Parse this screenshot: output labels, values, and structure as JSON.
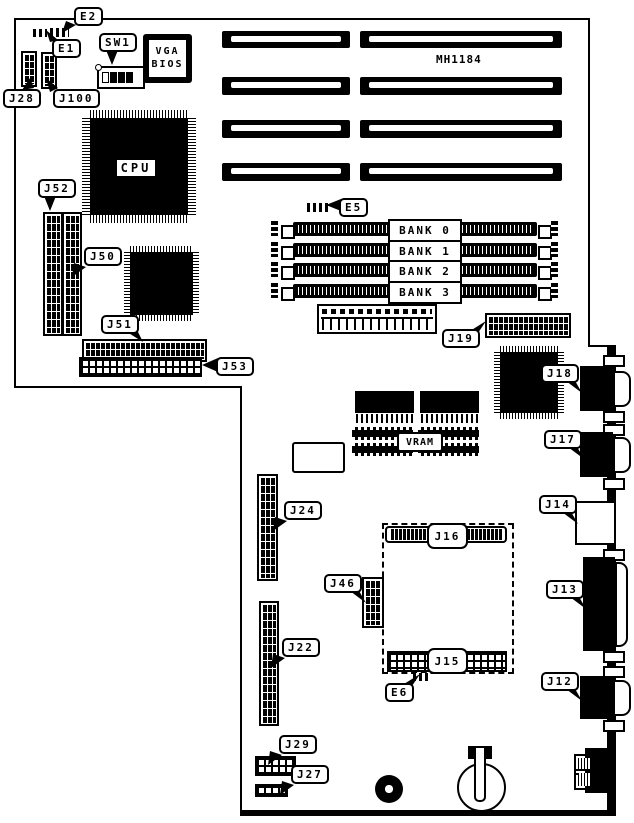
{
  "board": {
    "model": "MH1184"
  },
  "chips": {
    "cpu": "CPU",
    "vga_bios_line1": "VGA",
    "vga_bios_line2": "BIOS",
    "vram": "VRAM"
  },
  "memory_banks": [
    "BANK 0",
    "BANK 1",
    "BANK 2",
    "BANK 3"
  ],
  "socket_connectors": {
    "j16": "J16",
    "j15": "J15"
  },
  "callouts": {
    "e1": "E1",
    "e2": "E2",
    "e5": "E5",
    "e6": "E6",
    "sw1": "SW1",
    "j12": "J12",
    "j13": "J13",
    "j14": "J14",
    "j17": "J17",
    "j18": "J18",
    "j19": "J19",
    "j22": "J22",
    "j24": "J24",
    "j27": "J27",
    "j28": "J28",
    "j29": "J29",
    "j46": "J46",
    "j50": "J50",
    "j51": "J51",
    "j52": "J52",
    "j53": "J53",
    "j100": "J100"
  }
}
